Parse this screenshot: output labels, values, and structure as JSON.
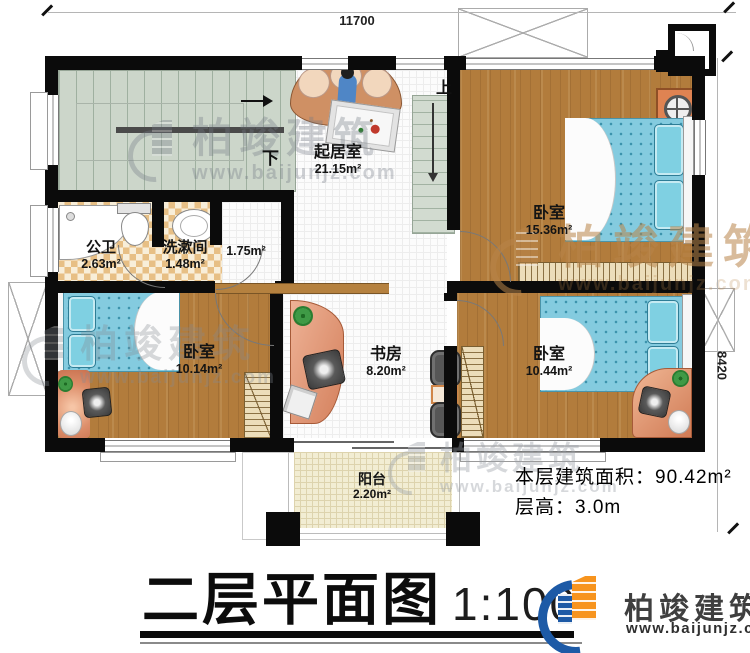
{
  "dimensions": {
    "width_top": "11700",
    "height_right": "8420"
  },
  "stairs": {
    "down_label": "下",
    "up_label": "上"
  },
  "rooms": {
    "living": {
      "name": "起居室",
      "area": "21.15m²"
    },
    "bedroom_top": {
      "name": "卧室",
      "area": "15.36m²"
    },
    "bedroom_left": {
      "name": "卧室",
      "area": "10.14m²"
    },
    "bedroom_right": {
      "name": "卧室",
      "area": "10.44m²"
    },
    "study": {
      "name": "书房",
      "area": "8.20m²"
    },
    "bathroom": {
      "name": "公卫",
      "area": "2.63m²"
    },
    "washroom": {
      "name": "洗漱间",
      "area": "1.48m²"
    },
    "hallway": {
      "area": "1.75m²"
    },
    "balcony": {
      "name": "阳台",
      "area": "2.20m²"
    }
  },
  "title": {
    "text": "二层平面图",
    "scale": "1:100"
  },
  "info": {
    "floor_area": "本层建筑面积：90.42m²",
    "floor_height": "层高：3.0m"
  },
  "brand": {
    "name": "柏竣建筑",
    "url": "www.baijunjz.com"
  }
}
